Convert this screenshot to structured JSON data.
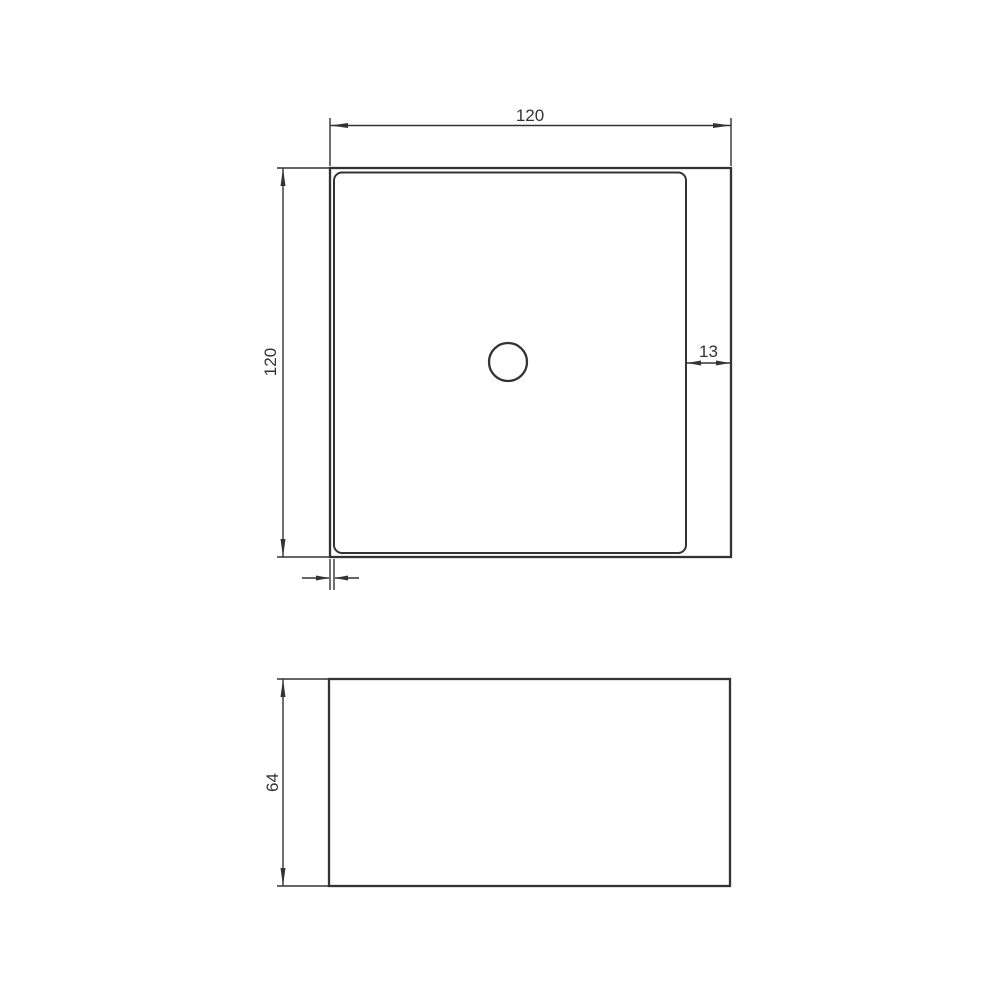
{
  "colors": {
    "line": "#333333",
    "text": "#333333",
    "background": "#ffffff"
  },
  "top_view": {
    "width_label": "120",
    "height_label": "120",
    "rim_gap_label": "13"
  },
  "front_view": {
    "height_label": "64"
  }
}
